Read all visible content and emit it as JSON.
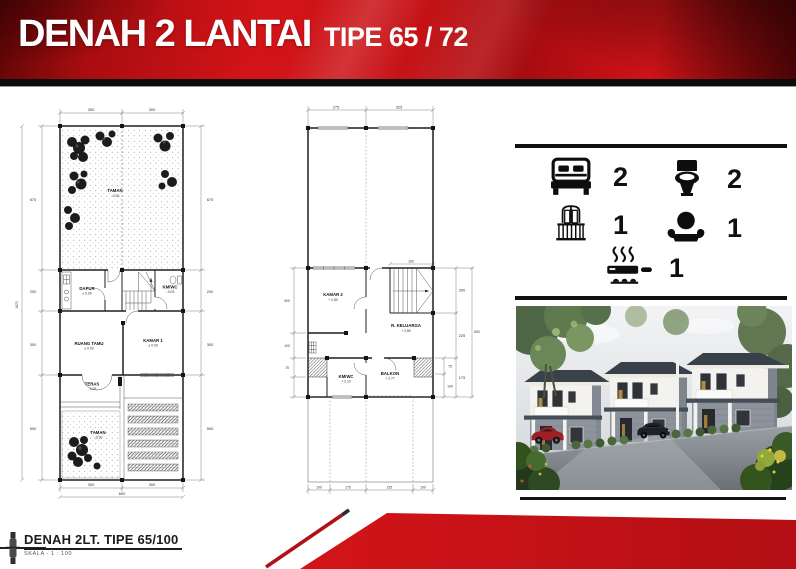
{
  "header": {
    "title": "DENAH 2 LANTAI",
    "subtitle": "TIPE 65 / 72"
  },
  "specs": {
    "items": [
      {
        "icon": "bed-icon",
        "count": "2"
      },
      {
        "icon": "toilet-icon",
        "count": "2"
      },
      {
        "icon": "balcony-icon",
        "count": "1"
      },
      {
        "icon": "armchair-icon",
        "count": "1"
      },
      {
        "icon": "stove-icon",
        "count": "1"
      }
    ]
  },
  "plan1": {
    "dims": {
      "top_a": "300",
      "top_b": "300",
      "left_total": "1670",
      "left_a": "670",
      "left_b": "200",
      "left_c": "300",
      "left_d": "500",
      "right_a": "670",
      "right_b": "200",
      "right_c": "300",
      "right_d": "500",
      "bottom_a": "300",
      "bottom_b": "300",
      "bottom_total": "600"
    },
    "rooms": {
      "taman_belakang": {
        "label": "TAMAN",
        "level": "- 0.05"
      },
      "dapur": {
        "label": "DAPUR",
        "level": "± 0.00"
      },
      "kmwc": {
        "label": "KM/WC",
        "level": "- 0.03"
      },
      "ruang_tamu": {
        "label": "RUANG TAMU",
        "level": "± 0.00"
      },
      "kamar1": {
        "label": "KAMAR 1",
        "level": "± 0.00"
      },
      "teras": {
        "label": "TERAS",
        "level": "- 0.05"
      },
      "taman_depan": {
        "label": "TAMAN",
        "level": "- 0.30"
      }
    }
  },
  "plan2": {
    "dims": {
      "top_a": "275",
      "top_b": "325",
      "stairs": "160",
      "left_a": "300",
      "left_b": "100",
      "left_c": "75",
      "right_a": "200",
      "right_b": "225",
      "right_c": "175",
      "right_d": "75",
      "right_e": "100",
      "right_total": "600",
      "bottom_a": "100",
      "bottom_b": "175",
      "bottom_c": "225",
      "bottom_d": "100"
    },
    "rooms": {
      "kamar2": {
        "label": "KAMAR 2",
        "level": "+ 2.80"
      },
      "r_keluarga": {
        "label": "R. KELUARGA",
        "level": "+ 2.80"
      },
      "kmwc": {
        "label": "KM/WC",
        "level": "+ 2.10"
      },
      "balkon": {
        "label": "BALKON",
        "level": "+ 2.77"
      }
    }
  },
  "footer": {
    "label": "DENAH 2LT. TIPE 65/100",
    "scale": "SKALA  -  1 : 100"
  },
  "colors": {
    "accent_red": "#c8131a",
    "deep_red": "#8f0a0d",
    "black": "#0d0d0d"
  }
}
